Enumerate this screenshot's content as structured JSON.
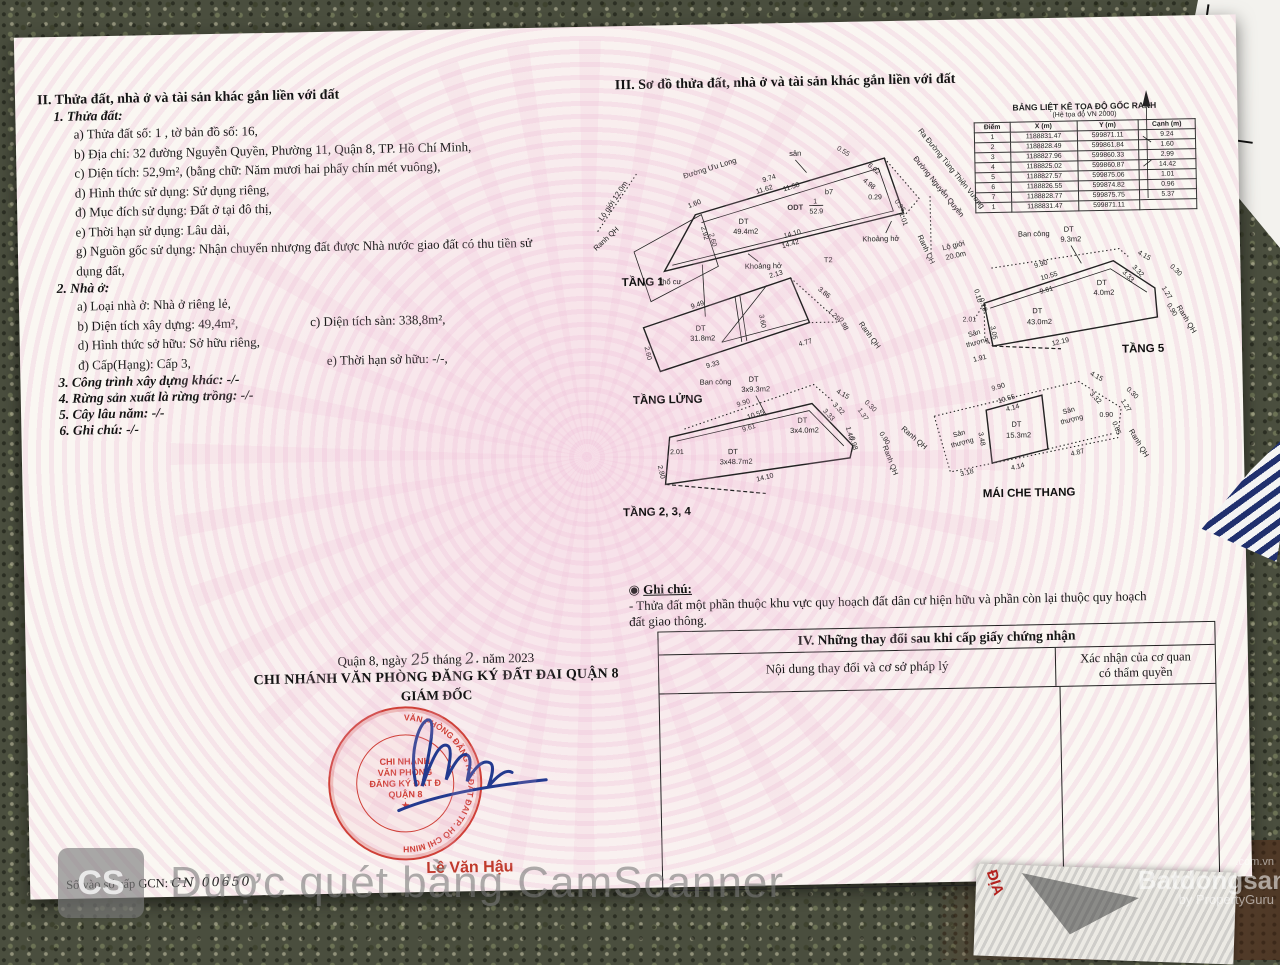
{
  "colors": {
    "stamp_red": "#cf4038",
    "signature_blue": "#233a8f",
    "name_red": "#c0392b",
    "paper": "#faf7f2",
    "guilloche_pink": "#efc3dc",
    "watermark_gray": "#9a9a9a"
  },
  "section2": {
    "title": "II. Thửa đất, nhà ở và tài sản khác gắn liền với đất",
    "thua_dat_title": "1. Thửa đất:",
    "lines": [
      "a) Thửa đất số: 1          , tờ bản đồ số: 16,",
      "b) Địa chỉ: 32 đường Nguyễn Quyền, Phường 11, Quận 8, TP. Hồ Chí Minh,",
      "c) Diện tích: 52,9m², (bằng chữ: Năm mươi hai phẩy chín mét vuông),",
      "d) Hình thức sử dụng: Sử dụng riêng,",
      "đ) Mục đích sử dụng: Đất ở tại đô thị,",
      "e) Thời hạn sử dụng: Lâu dài,",
      "g) Nguồn gốc sử dụng: Nhận chuyển nhượng đất được Nhà nước giao đất có thu tiền sử",
      "dụng đất,"
    ],
    "nha_o_title": "2. Nhà ở:",
    "nha_o_a": "a) Loại nhà ở: Nhà ở riêng lẻ,",
    "nha_o_b": "b) Diện tích xây dựng: 49,4m²,",
    "nha_o_c": "c) Diện tích sàn: 338,8m²,",
    "nha_o_d": "d) Hình thức sở hữu: Sở hữu riêng,",
    "nha_o_dd": "đ) Cấp(Hạng): Cấp 3,",
    "nha_o_e": "e) Thời hạn sở hữu: -/-,",
    "item3": "3. Công trình xây dựng khác: -/-",
    "item4": "4. Rừng sản xuất là rừng trồng: -/-",
    "item5": "5. Cây lâu năm: -/-",
    "item6": "6. Ghi chú: -/-"
  },
  "section3": {
    "title": "III. Sơ đồ thửa đất, nhà ở và tài sản khác gắn liền với đất"
  },
  "toado": {
    "title": "BẢNG LIỆT KÊ TỌA ĐỘ GỐC RANH",
    "subtitle": "(Hệ tọa độ VN 2000)",
    "headers": [
      "Điểm",
      "X (m)",
      "Y (m)",
      "Cạnh (m)"
    ],
    "rows": [
      [
        "1",
        "1188831.47",
        "599871.11",
        "9.24"
      ],
      [
        "2",
        "1188828.49",
        "599861.84",
        "1.60"
      ],
      [
        "3",
        "1188827.96",
        "599860.33",
        "2.99"
      ],
      [
        "4",
        "1188825.02",
        "599860.87",
        "14.42"
      ],
      [
        "5",
        "1188827.57",
        "599875.06",
        "1.01"
      ],
      [
        "6",
        "1188826.55",
        "599874.82",
        "0.96"
      ],
      [
        "7",
        "1188828.77",
        "599875.75",
        "5.37"
      ],
      [
        "1",
        "1188831.47",
        "599871.11",
        ""
      ]
    ]
  },
  "sodo": {
    "right_labels": {
      "ra_duong": "Ra Đường Tùng Thiện Vương",
      "duong_nq": "Đường Nguyễn Quyền",
      "ranh_qh": "Ranh QH",
      "lo_gioi": "Lộ giới",
      "lo_gioi2": "20.0m"
    },
    "tang1": {
      "name": "TẦNG 1",
      "street": "Đường Ưu Long",
      "san": "sân",
      "odt": "ODT",
      "odt_num": "1",
      "odt_den": "52.9",
      "b7": "b7",
      "dt": "DT",
      "area": "49.4m2",
      "tho_cu": "Thổ cư",
      "khoang_ho": "Khoảng hở",
      "t2": "T2",
      "lo_gioi": "Lộ giới 12.0m",
      "ranh_qh": "Ranh QH",
      "dims": [
        "9.74",
        "11.62",
        "11.58",
        "0.55",
        "6.02",
        "4.98",
        "0.29",
        "0.96",
        "1.01",
        "14.10",
        "14.42",
        "1.60",
        "2.92",
        "2.60"
      ]
    },
    "tang_lung": {
      "name": "TẦNG LỬNG",
      "dt": "DT",
      "area": "31.8m2",
      "ranh_qh": "Ranh QH",
      "dims": [
        "9.49",
        "2.13",
        "3.86",
        "1.25",
        "0.98",
        "3.60",
        "4.77",
        "9.33",
        "2.60"
      ]
    },
    "tang234": {
      "name": "TẦNG 2, 3, 4",
      "bancong": "Ban công",
      "bancong_dt": "DT",
      "bancong_area": "3x9.3m2",
      "dt1": "DT",
      "dt1_area": "3x4.0m2",
      "dt2": "DT",
      "dt2_area": "3x48.7m2",
      "ranh_qh": "Ranh QH",
      "dims": [
        "9.90",
        "10.55",
        "9.61",
        "4.15",
        "3.32",
        "3.33",
        "1.37",
        "0.30",
        "0.90",
        "1.40",
        "0.98",
        "2.01",
        "2.80",
        "14.10"
      ]
    },
    "tang5": {
      "name": "TẦNG 5",
      "bancong": "Ban công",
      "bancong_dt": "DT",
      "bancong_area": "9.3m2",
      "dt1": "DT",
      "dt1_area": "4.0m2",
      "dt2": "DT",
      "dt2_area": "43.0m2",
      "san_thuong": "Sân",
      "san_thuong2": "thượng",
      "ranh_qh": "Ranh QH",
      "dims": [
        "9.90",
        "10.55",
        "9.61",
        "4.15",
        "3.32",
        "3.33",
        "1.27",
        "0.30",
        "0.90",
        "2.01",
        "3.05",
        "12.19",
        "1.91",
        "0.10",
        "0.18"
      ]
    },
    "mai": {
      "name": "MÁI CHE THANG",
      "dt": "DT",
      "area": "15.3m2",
      "san_thuong": "Sân",
      "san_thuong2": "thượng",
      "ranh_qh": "Ranh QH",
      "dims": [
        "9.90",
        "10.55",
        "4.14",
        "3.48",
        "4.14",
        "3.18",
        "4.87",
        "4.15",
        "3.32",
        "0.30",
        "1.27",
        "0.90",
        "0.65"
      ]
    }
  },
  "ghichu": {
    "bullet": "◉",
    "title": "Ghi chú:",
    "line1": "- Thửa đất một phần thuộc khu vực quy hoạch đất dân cư hiện hữu và phần còn lại thuộc quy hoạch",
    "line2": "đất giao thông."
  },
  "section4": {
    "title": "IV. Những thay đổi sau khi cấp giấy chứng nhận",
    "col1": "Nội dung thay đổi và cơ sở pháp lý",
    "col2a": "Xác nhận của cơ quan",
    "col2b": "có thẩm quyền"
  },
  "footer": {
    "date_pre": "Quận 8, ngày",
    "date_day": "25",
    "date_mid": "tháng",
    "date_month": "2.",
    "date_post": "năm 2023",
    "office": "CHI NHÁNH VĂN PHÒNG ĐĂNG KÝ ĐẤT ĐAI QUẬN 8",
    "role": "GIÁM ĐỐC",
    "signer": "Lê Văn Hậu",
    "so_vao_so_label": "Số vào sổ cấp GCN:",
    "so_vao_so_value": "CN 00650"
  },
  "stamp": {
    "ring": "VĂN PHÒNG ĐĂNG KÝ ĐẤT ĐAI TP. HỒ CHÍ MINH",
    "line1": "CHI NHÁNH",
    "line2": "VĂN PHÒNG",
    "line3": "ĐĂNG KÝ ĐẤT Đ",
    "line4": "QUẬN 8",
    "star": "★"
  },
  "watermarks": {
    "cs": "CS",
    "camscanner": "Được quét bằng CamScanner",
    "brand_sup": ".com.vn",
    "brand": "Batdongsan",
    "brand_sub": "by PropertyGuru"
  },
  "bottom_doc": {
    "red_text": "ĐỊA"
  }
}
